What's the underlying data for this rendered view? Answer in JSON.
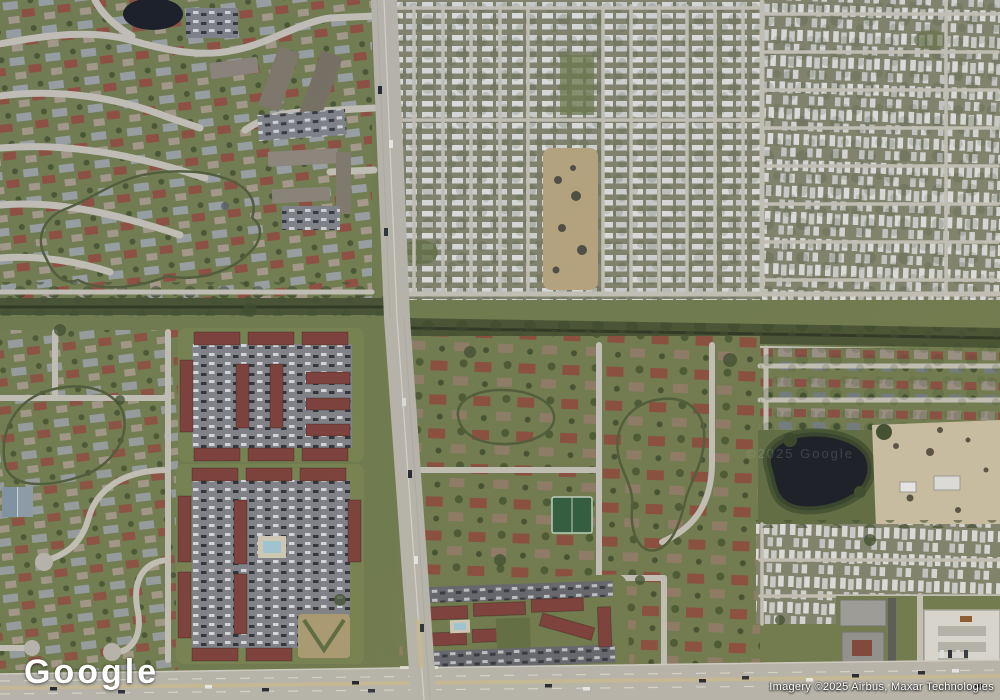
{
  "map": {
    "view": "satellite",
    "logo_text": "Google",
    "attribution_text": "Imagery ©2025 Airbus, Maxar Technologies",
    "tile_watermark": "©2025 Google"
  },
  "colors": {
    "grass": "#6e794b",
    "grass_dark": "#5a6540",
    "trees": "#3c4a2b",
    "water": "#161a22",
    "road": "#b7b4aa",
    "road_minor": "#c2bfb4",
    "highway_median": "#c6b995",
    "roof_red": "#8e4a3c",
    "roof_maroon": "#7b3d37",
    "roof_gray": "#9da0a3",
    "trailer_white": "#d9dad9",
    "parking": "#7e8086",
    "sand": "#c9bda2",
    "court_green": "#2e5a3b",
    "pool_blue": "#9fc6d3",
    "canal_green": "#46502f"
  }
}
